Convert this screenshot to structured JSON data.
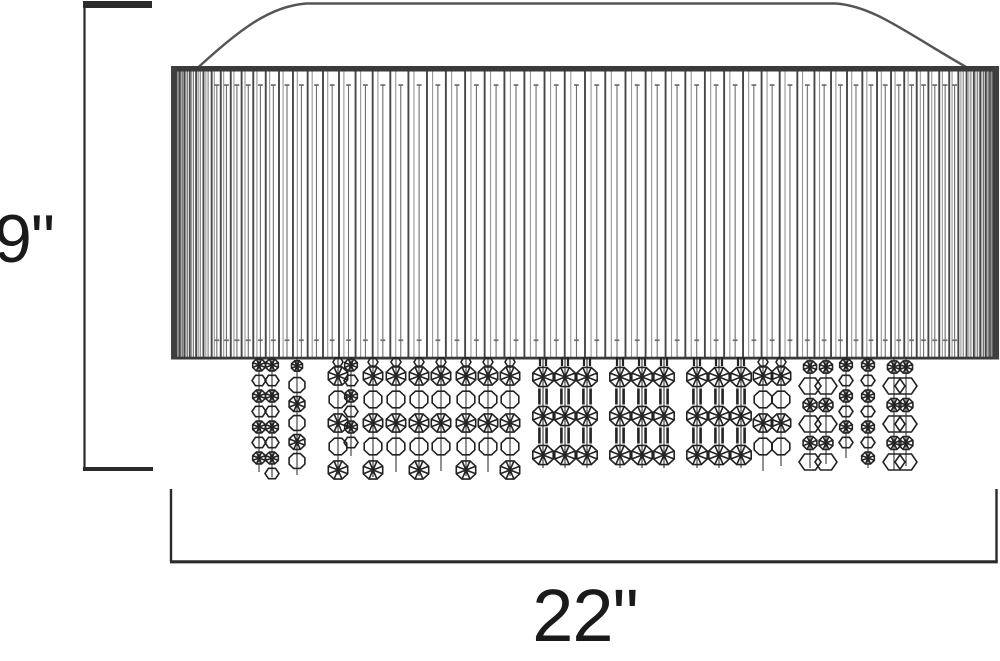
{
  "dimensions": {
    "height": {
      "label": "9\""
    },
    "width": {
      "label": "22\""
    }
  },
  "drawing": {
    "canvas": {
      "w": 1000,
      "h": 661
    },
    "colors": {
      "ink": "#2b2b2b",
      "canopy": "#555555",
      "shade_bar": "#3a3a3a",
      "shade_edge": "#3f3f3f",
      "pleat_dark": "#474747",
      "pleat_light": "#979797",
      "pleat_mid": "#6e6e6e",
      "bead": "#232323",
      "label": "#1a1a1a"
    },
    "canopy": {
      "top_y": 3.5,
      "top_x1": 306,
      "top_x2": 836,
      "base_y": 67.5,
      "base_x1": 198,
      "base_x2": 967
    },
    "shade": {
      "left": 172,
      "right": 998,
      "top": 66,
      "bottom": 359.5,
      "bar_h": 5.5,
      "bottom_bar_h": 2.8,
      "edge_w": 6,
      "pleat_top": 71,
      "pleat_bottom": 357
    },
    "pleats": {
      "base_steps": 64,
      "pair_offset": 0.3,
      "mid_offset": 0.58,
      "cap_min_gap": 9,
      "mid_start": 85,
      "cap_top_y": 84.2,
      "cap_bottom_y": 339.4,
      "cap_w": 4.8,
      "cap_h": 1.7
    },
    "strand_top": 357,
    "strands": [
      {
        "x": 259,
        "style": "sm",
        "bottom": 474
      },
      {
        "x": 272,
        "style": "sm",
        "bottom": 479
      },
      {
        "x": 297,
        "style": "md",
        "bottom": 477
      },
      {
        "x": 338,
        "style": "lg",
        "bottom": 477
      },
      {
        "x": 351,
        "style": "sm",
        "bottom": 458
      },
      {
        "x": 373,
        "style": "lg",
        "bottom": 479
      },
      {
        "x": 396,
        "style": "lg",
        "bottom": 474
      },
      {
        "x": 419,
        "style": "lg",
        "bottom": 478
      },
      {
        "x": 441,
        "style": "lg",
        "bottom": 473
      },
      {
        "x": 466,
        "style": "lg",
        "bottom": 478
      },
      {
        "x": 488,
        "style": "lg",
        "bottom": 474
      },
      {
        "x": 510,
        "style": "lg",
        "bottom": 478
      },
      {
        "x": 543,
        "style": "LG",
        "bottom": 470
      },
      {
        "x": 565,
        "style": "LG",
        "bottom": 470
      },
      {
        "x": 587,
        "style": "LG",
        "bottom": 470
      },
      {
        "x": 620,
        "style": "LG",
        "bottom": 470
      },
      {
        "x": 642,
        "style": "LG",
        "bottom": 470
      },
      {
        "x": 664,
        "style": "LG",
        "bottom": 470
      },
      {
        "x": 697,
        "style": "LG",
        "bottom": 470
      },
      {
        "x": 719,
        "style": "LG",
        "bottom": 470
      },
      {
        "x": 741,
        "style": "LG",
        "bottom": 470
      },
      {
        "x": 763,
        "style": "lg",
        "bottom": 473
      },
      {
        "x": 781,
        "style": "lg",
        "bottom": 468
      },
      {
        "x": 810,
        "style": "hx",
        "bottom": 470
      },
      {
        "x": 826,
        "style": "hx",
        "bottom": 466
      },
      {
        "x": 846,
        "style": "sm",
        "bottom": 460
      },
      {
        "x": 868,
        "style": "sm",
        "bottom": 470
      },
      {
        "x": 894,
        "style": "hx",
        "bottom": 472
      },
      {
        "x": 906,
        "style": "hx",
        "bottom": 468
      }
    ],
    "dim_height": {
      "line_x": 84.5,
      "top": 8,
      "bottom": 467,
      "tick_x": 83,
      "tick_len": 69,
      "top_tick": {
        "y": 1,
        "h": 7
      },
      "bottom_tick": {
        "y": 467,
        "h": 4
      }
    },
    "dim_width": {
      "left": 171,
      "right": 996.5,
      "riser_top": 489,
      "bar_y": 561.8,
      "bar_x1": 170,
      "bar_x2": 997.8
    }
  }
}
